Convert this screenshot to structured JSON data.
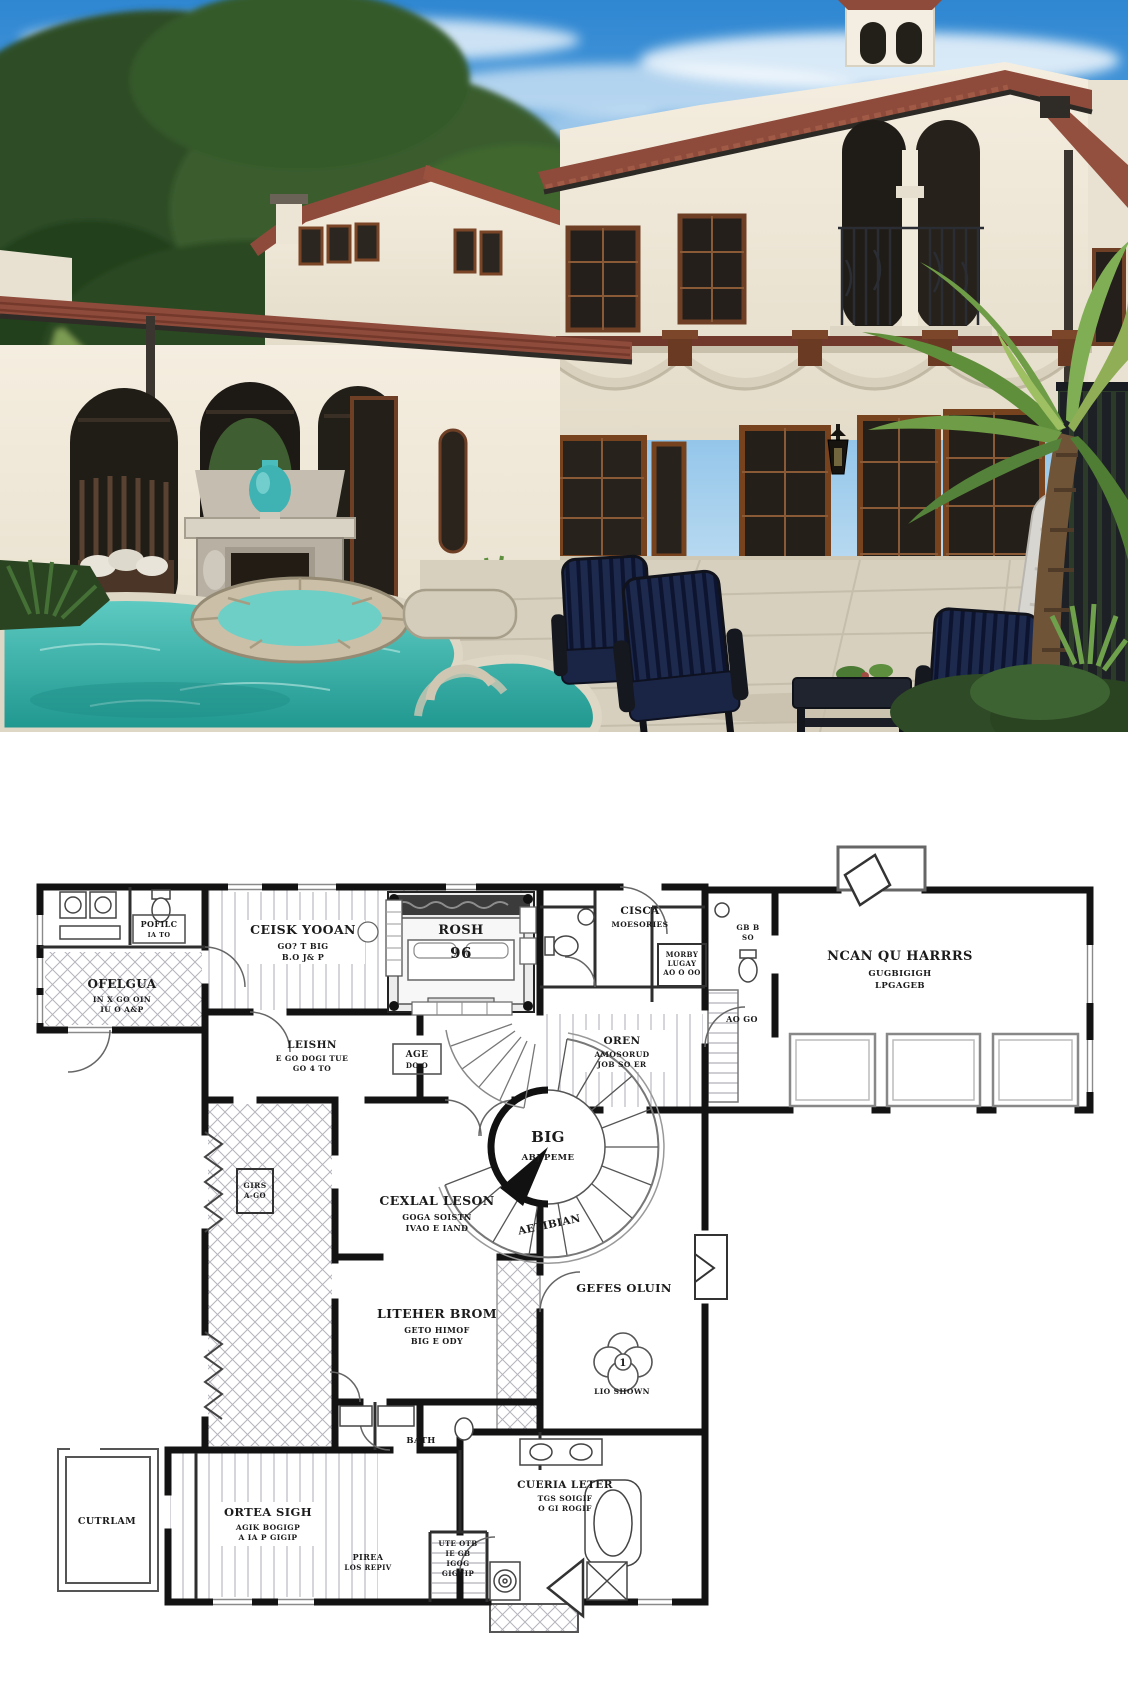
{
  "photo": {
    "description": "Mediterranean stucco house with tile roof, arched loggia, outdoor fireplace, pool, spa, palm tree and navy patio furniture",
    "colors": {
      "sky": "#2f87d2",
      "stucco": "#f0e9da",
      "roof_tile": "#8e4b3b",
      "pool_water": "#38b7ae",
      "wood_trim": "#77431f",
      "cushions": "#1d2a4e",
      "vase": "#3fb3b3",
      "palm_green": "#5f8f3a"
    }
  },
  "floor_plan": {
    "stair": {
      "label": "BIG",
      "sub": "ABJ PEME",
      "curved": "AETIBIAN"
    },
    "fountain": {
      "number": "1",
      "caption": "LIO SHOWN"
    },
    "rooms": [
      {
        "id": "pofilc",
        "lines": [
          "POFILC",
          "IA TO"
        ]
      },
      {
        "id": "ofelgua",
        "lines": [
          "OFELGUA",
          "IN X GO OIN",
          "IU O A&P"
        ]
      },
      {
        "id": "ceisk",
        "lines": [
          "CEISK YOOAN",
          "GO? T BIG",
          "B.O J& P"
        ]
      },
      {
        "id": "rosh",
        "lines": [
          "ROSH",
          "96"
        ]
      },
      {
        "id": "leishn",
        "lines": [
          "LEISHN",
          "E GO DOGI TUE",
          "GO 4 TO"
        ]
      },
      {
        "id": "age",
        "lines": [
          "AGE",
          "DO O"
        ]
      },
      {
        "id": "cisca",
        "lines": [
          "CISCA",
          "MOESORIES"
        ]
      },
      {
        "id": "morby",
        "lines": [
          "MORBY",
          "LUGAY",
          "AO O OO"
        ]
      },
      {
        "id": "oren",
        "lines": [
          "OREN",
          "AMOSORUD",
          "JOB SO ER"
        ]
      },
      {
        "id": "gbb",
        "lines": [
          "GB B",
          "SO"
        ]
      },
      {
        "id": "aogo",
        "lines": [
          "AO GO"
        ]
      },
      {
        "id": "garage",
        "lines": [
          "NCAN QU HARRRS",
          "GUGBIGIGH",
          "LPGAGEB"
        ]
      },
      {
        "id": "central",
        "lines": [
          "CEXLAL LESON",
          "GOGA SOISTN",
          "IVAO E IAND"
        ]
      },
      {
        "id": "kitchen",
        "lines": [
          "LITEHER BROM",
          "GETO HIMOF",
          "BIG E ODY"
        ]
      },
      {
        "id": "girs",
        "lines": [
          "GIRS",
          "A-GO"
        ]
      },
      {
        "id": "gefes",
        "lines": [
          "GEFES OLUIN"
        ]
      },
      {
        "id": "cutrlam",
        "lines": [
          "CUTRLAM"
        ]
      },
      {
        "id": "office",
        "lines": [
          "ORTEA SIGH",
          "AGIK BOGIGP",
          "A IA P GIGIP"
        ]
      },
      {
        "id": "bath",
        "lines": [
          "BATH"
        ]
      },
      {
        "id": "pirea",
        "lines": [
          "PIREA",
          "LOS REPIV"
        ]
      },
      {
        "id": "ute",
        "lines": [
          "UTE OTB",
          "IE GB",
          "IGOG",
          "GIGUIP"
        ]
      },
      {
        "id": "cueria",
        "lines": [
          "CUERIA LETER",
          "TGS SOIGIF",
          "O GI ROGIF"
        ]
      }
    ]
  }
}
